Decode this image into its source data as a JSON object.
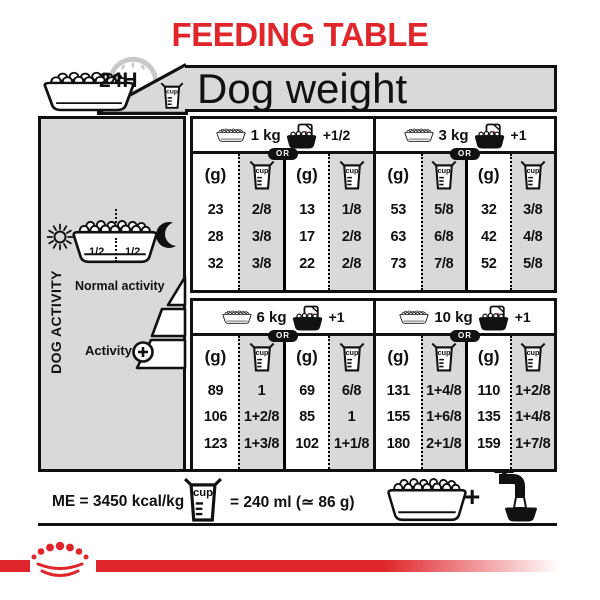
{
  "title": "FEEDING TABLE",
  "colors": {
    "red": "#e0262b",
    "gray": "#d9d9d9",
    "black": "#111111"
  },
  "header": {
    "hours": "24H",
    "dog_weight": "Dog weight"
  },
  "icons": {
    "cup_label": "cup"
  },
  "sidebar": {
    "vertical_label": "DOG ACTIVITY",
    "half_left": "1/2",
    "half_right": "1/2",
    "normal_activity": "Normal activity",
    "activity": "Activity"
  },
  "sections": [
    {
      "weight": "1 kg",
      "or": "OR",
      "extra": "+1/2",
      "g": "(g)",
      "columns": [
        "(g)",
        "cup",
        "(g)",
        "cup"
      ],
      "rows": [
        [
          "23",
          "2/8",
          "13",
          "1/8"
        ],
        [
          "28",
          "3/8",
          "17",
          "2/8"
        ],
        [
          "32",
          "3/8",
          "22",
          "2/8"
        ]
      ]
    },
    {
      "weight": "3 kg",
      "or": "OR",
      "extra": "+1",
      "g": "(g)",
      "columns": [
        "(g)",
        "cup",
        "(g)",
        "cup"
      ],
      "rows": [
        [
          "53",
          "5/8",
          "32",
          "3/8"
        ],
        [
          "63",
          "6/8",
          "42",
          "4/8"
        ],
        [
          "73",
          "7/8",
          "52",
          "5/8"
        ]
      ]
    },
    {
      "weight": "6 kg",
      "or": "OR",
      "extra": "+1",
      "g": "(g)",
      "columns": [
        "(g)",
        "cup",
        "(g)",
        "cup"
      ],
      "rows": [
        [
          "89",
          "1",
          "69",
          "6/8"
        ],
        [
          "106",
          "1+2/8",
          "85",
          "1"
        ],
        [
          "123",
          "1+3/8",
          "102",
          "1+1/8"
        ]
      ]
    },
    {
      "weight": "10 kg",
      "or": "OR",
      "extra": "+1",
      "g": "(g)",
      "columns": [
        "(g)",
        "cup",
        "(g)",
        "cup"
      ],
      "rows": [
        [
          "131",
          "1+4/8",
          "110",
          "1+2/8"
        ],
        [
          "155",
          "1+6/8",
          "135",
          "1+4/8"
        ],
        [
          "180",
          "2+1/8",
          "159",
          "1+7/8"
        ]
      ]
    }
  ],
  "footer": {
    "me": "ME = 3450 kcal/kg",
    "cup_equals": "= 240 ml (≃ 86 g)",
    "plus": "+"
  }
}
